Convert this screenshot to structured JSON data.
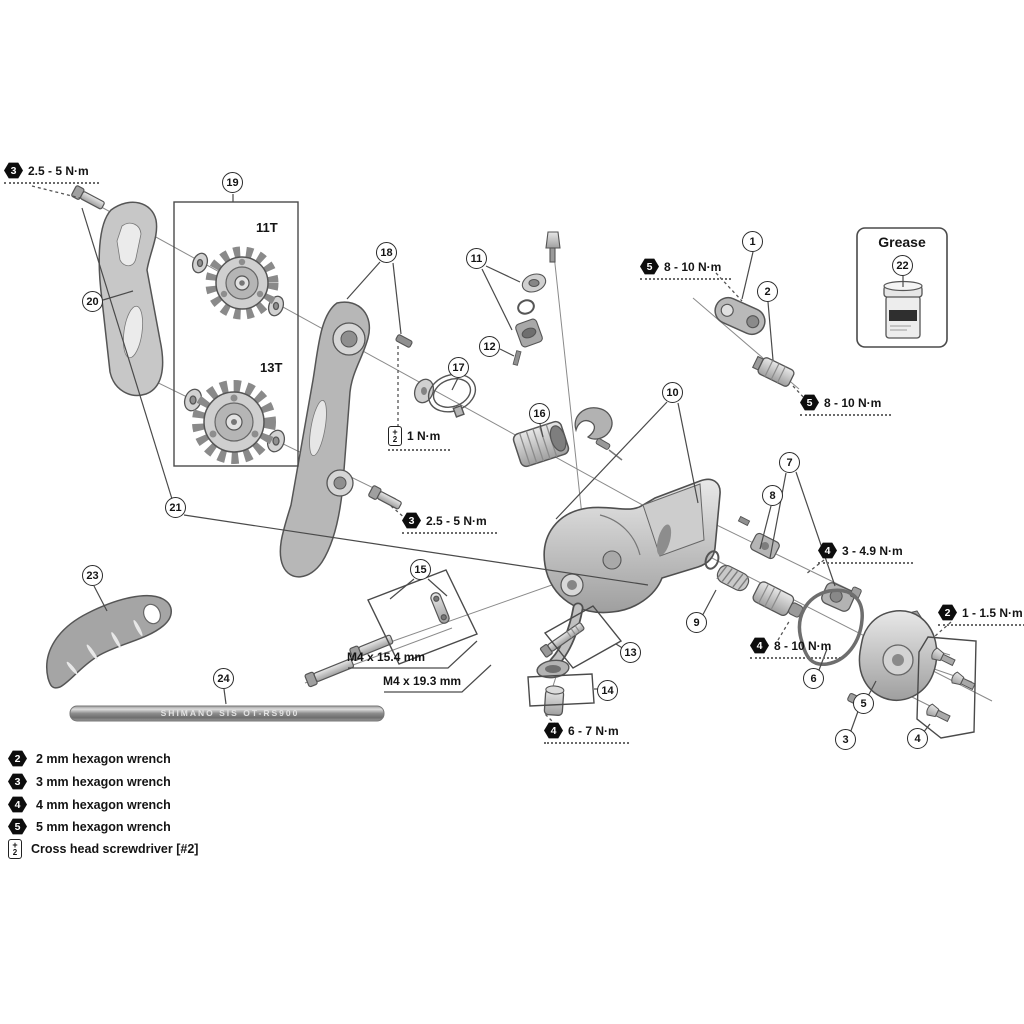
{
  "parts": [
    "1",
    "2",
    "3",
    "4",
    "5",
    "6",
    "7",
    "8",
    "9",
    "10",
    "11",
    "12",
    "13",
    "14",
    "15",
    "16",
    "17",
    "18",
    "19",
    "20",
    "21",
    "22",
    "23",
    "24"
  ],
  "torques": [
    {
      "tool": "3",
      "value": "2.5 - 5 N·m"
    },
    {
      "tool": "5",
      "value": "8 - 10 N·m"
    },
    {
      "tool": "5",
      "value": "8 - 10 N·m"
    },
    {
      "tool": "ph",
      "value": "1 N·m"
    },
    {
      "tool": "3",
      "value": "2.5 - 5 N·m"
    },
    {
      "tool": "4",
      "value": "3 - 4.9 N·m"
    },
    {
      "tool": "4",
      "value": "8 - 10 N·m"
    },
    {
      "tool": "2",
      "value": "1 - 1.5 N·m"
    },
    {
      "tool": "4",
      "value": "6 - 7 N·m"
    }
  ],
  "annotations": {
    "pulley_top": "11T",
    "pulley_bottom": "13T",
    "bolt_a": "M4 x 15.4 mm",
    "bolt_b": "M4 x 19.3 mm",
    "grease": "Grease",
    "cable_marking": "SHIMANO SIS OT-RS900"
  },
  "icons": {
    "phillips_cross": "+",
    "phillips_num": "2"
  },
  "legend": [
    {
      "tool": "2",
      "label": "2 mm hexagon wrench"
    },
    {
      "tool": "3",
      "label": "3 mm hexagon wrench"
    },
    {
      "tool": "4",
      "label": "4 mm hexagon wrench"
    },
    {
      "tool": "5",
      "label": "5 mm hexagon wrench"
    },
    {
      "tool": "ph",
      "label": "Cross head screwdriver [#2]"
    }
  ],
  "colors": {
    "line": "#4a4a4a",
    "badge": "#0d0d0d",
    "metal_light": "#e8e8e8",
    "metal_dark": "#9f9f9f"
  }
}
